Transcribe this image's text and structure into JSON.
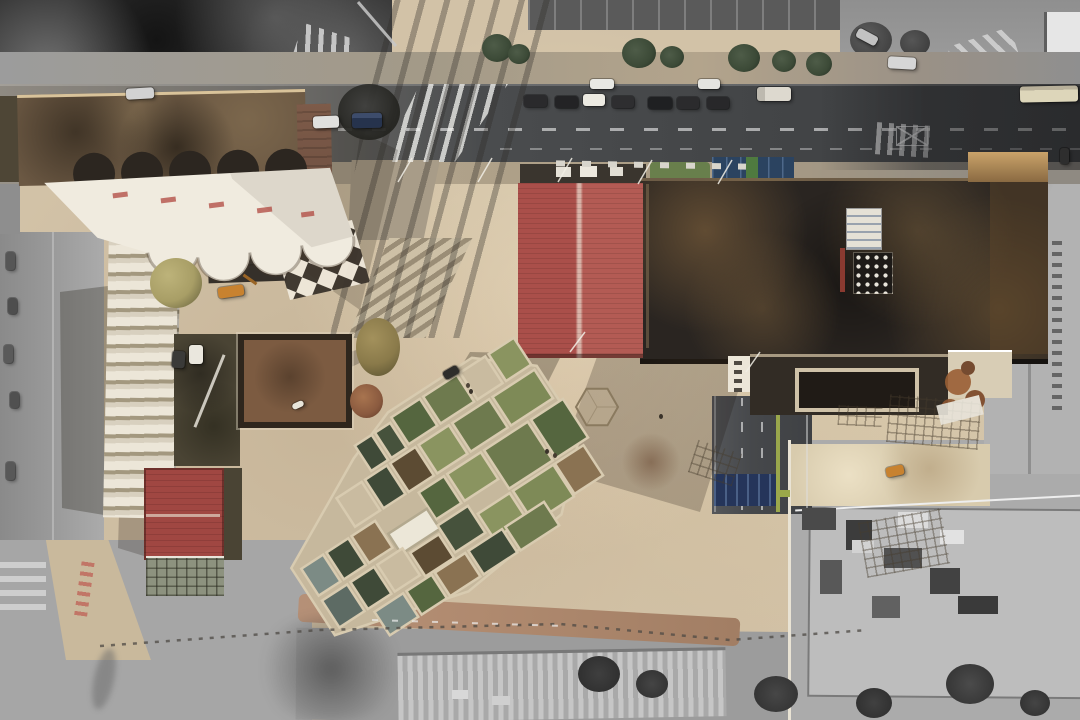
{
  "image": {
    "kind": "aerial-drone-photograph",
    "subject": "top-down urban renewal site: historic hall with white scalloped shell roof, red pitched metal roof, dark industrial hall, terraced courtyard housing with green roof gardens, plaza, roads with parked cars; surrounding context desaturated to grayscale"
  },
  "colors": {
    "plaza": "#d2c2a7",
    "plazaLight": "#e4d6bc",
    "plazaDark": "#bcab90",
    "asphalt": "#434547",
    "roadPale": "#8f8a82",
    "grayLight": "#b5b5b5",
    "gray": "#9d9d9d",
    "grayMid": "#8a8a8a",
    "grayDark": "#6e6e6e",
    "inkTrees": "#2c2c2c",
    "redRoofL": "#aa4f4a",
    "redRoofR": "#b35b54",
    "redRidge": "#d9b3a8",
    "redSmall": "#a04742",
    "hallDark": "#2a2521",
    "hallBrown": "#6b5138",
    "parapet": "#d9c39a",
    "sunEdge": "#daa968",
    "annexDark": "#322c25",
    "annexInner": "#201b16",
    "frameBeige": "#cfc2a8",
    "whiteRoof": "#f0ebdf",
    "brownRoof": "#6b5843",
    "brickWall": "#7d5b49",
    "stepWhite": "#ece6d8",
    "stepShadow": "#a3987f",
    "gardenDark": "#4a4434",
    "courtBlue": "#2b4360",
    "laneGreen": "#a9b84e",
    "grassGreen": "#5d7a42",
    "clusterBase": "#c6b89d",
    "clusterWall": "#d8cbb0",
    "gOlive": "#6e7a4e",
    "gPine": "#3f4a38",
    "gLight": "#8a9460",
    "gDeep": "#55663f",
    "pool": "#7c8b85",
    "pool2": "#5d6b64",
    "dirt": "#8a7252",
    "soil": "#5c4b33",
    "pathRed": "#b08a6f",
    "navy": "#25355a",
    "orange": "#c8822f",
    "treeOlive": "#a89e66",
    "treeBrown": "#8a7a4a",
    "treeGreen": "#3c4a37",
    "treeRust": "#8a5a3f",
    "checkDark": "#3a332b",
    "busCream": "#ddd6ba"
  },
  "scene": {
    "objects": [
      "white-scalloped-shell-roof-hall",
      "vault-end-discs",
      "checkerboard-plaza",
      "red-gable-metal-roof",
      "industrial-hall-dark-roof",
      "skylight-dot-grid",
      "terraced-housing-cluster-green-courtyards",
      "white-shed-roof",
      "stepped-white-apartment",
      "courtyard-building",
      "small-red-roof-pavilion",
      "greenhouse-grid",
      "hexagon-pavilion",
      "main-road-with-parked-cars",
      "zebra-crossing",
      "pole-shadow-stripes",
      "bike-lane-road-green-line",
      "blue-sports-court",
      "construction-zone-grayscale",
      "city-bus",
      "excavator",
      "plaza-trees",
      "rooftop-hvac-units",
      "boundary-hatch-line"
    ]
  }
}
